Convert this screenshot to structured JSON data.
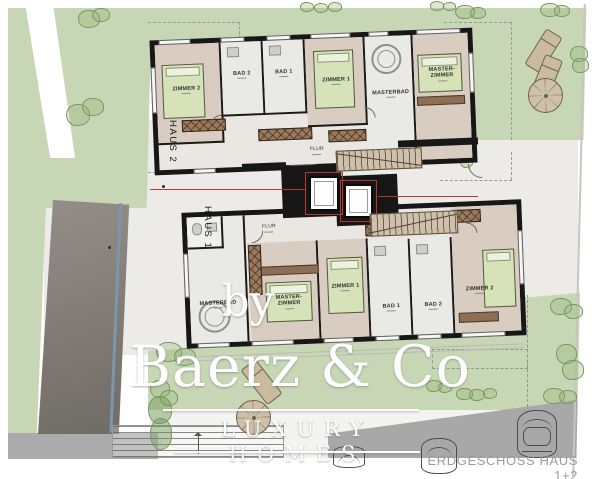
{
  "caption": "ERDGESCHOSS HAUS 1+2",
  "watermark": {
    "prefix": "by",
    "brand": "Baerz & Co",
    "tagline": "LUXURY HOMES"
  },
  "houses": {
    "haus2": {
      "name": "HAUS 2",
      "hall": "FLUR",
      "rooms": {
        "zimmer2": "ZIMMER 2",
        "bad2": "BAD 2",
        "bad1": "BAD 1",
        "zimmer1": "ZIMMER 1",
        "masterbad": "MASTERBAD",
        "master": "MASTER-ZIMMER"
      }
    },
    "haus1": {
      "name": "HAUS 1",
      "hall": "FLUR",
      "rooms": {
        "masterbad": "MASTERBAD",
        "master": "MASTER-ZIMMER",
        "zimmer1": "ZIMMER 1",
        "bad1": "BAD 1",
        "bad2": "BAD 2",
        "zimmer2": "ZIMMER 2"
      }
    }
  },
  "colors": {
    "lawn": "#c7d7b5",
    "paving": "#ecebe8",
    "wall": "#171717",
    "wood": "#9b7a5c",
    "bed": "#d6e3b9",
    "room_floor": "#d8cdc0",
    "bath_floor": "#e9e9e6",
    "section_red": "#b03a30",
    "asphalt": "#a8a8a8",
    "ramp": "#7f7a74"
  }
}
